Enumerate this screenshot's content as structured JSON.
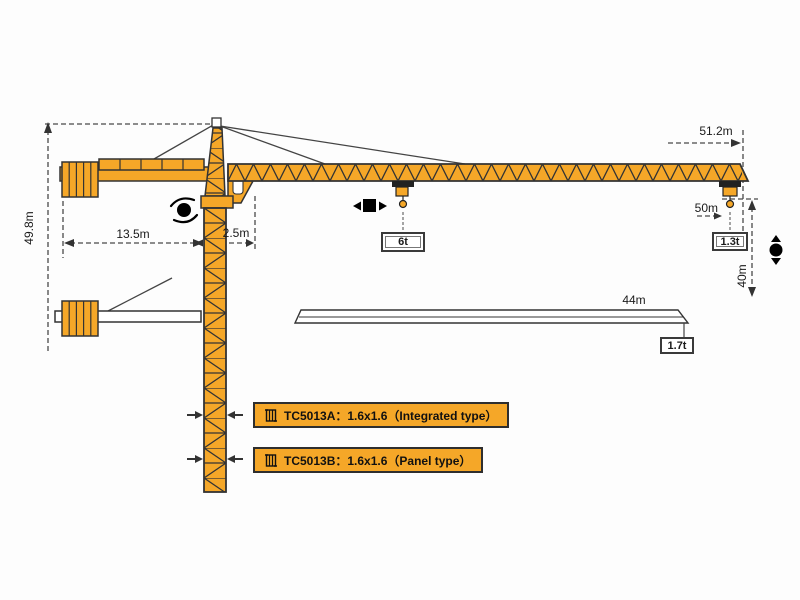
{
  "diagram": {
    "dimensions": {
      "total_height": "49.8m",
      "counter_jib_length": "13.5m",
      "jib_root_offset": "2.5m",
      "max_working_radius": "51.2m",
      "jib_length_long": "50m",
      "hook_clearance": "40m",
      "jib_length_short": "44m"
    },
    "loads": {
      "hook_mid_load": "6t",
      "tip_load_long_jib": "1.3t",
      "tip_load_short_jib": "1.7t"
    },
    "models": {
      "integrated": "TC5013A：1.6x1.6（Integrated type）",
      "panel": "TC5013B：1.6x1.6（Panel type）"
    },
    "icons": {
      "slewing": "rotation-dot-with-arc-arrows",
      "trolley": "square-with-left-right-arrows",
      "hoist": "dot-with-up-down-arrows",
      "mast_section": "mast-cross-section-symbol"
    },
    "colors": {
      "crane_orange": "#F5A728",
      "outline_dark": "#333333",
      "dim_line": "#4a4a4a",
      "load_box_bg": "#FFFFFF"
    }
  }
}
